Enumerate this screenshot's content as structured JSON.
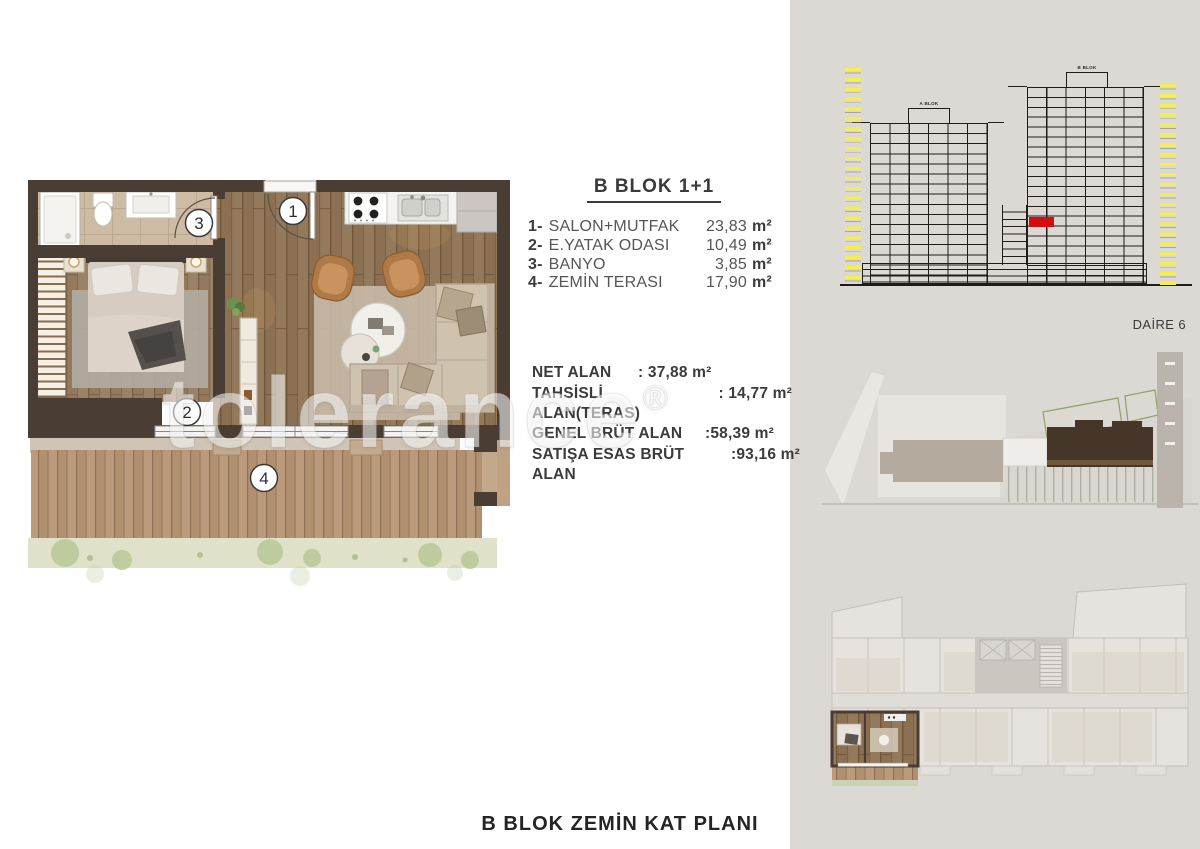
{
  "unit_info": {
    "title": "B BLOK 1+1",
    "rooms": [
      {
        "num": "1-",
        "label": "SALON+MUTFAK",
        "area": "23,83",
        "unit": "m²"
      },
      {
        "num": "2-",
        "label": "E.YATAK ODASI",
        "area": "10,49",
        "unit": "m²"
      },
      {
        "num": "3-",
        "label": "BANYO",
        "area": "3,85",
        "unit": "m²"
      },
      {
        "num": "4-",
        "label": "ZEMİN TERASI",
        "area": "17,90",
        "unit": "m²"
      }
    ],
    "areas_primary": [
      {
        "label": "NET ALAN",
        "value": ": 37,88 m²"
      },
      {
        "label": "TAHSİSLİ ALAN(TERAS)",
        "value": " : 14,77 m²"
      }
    ],
    "areas_secondary": [
      {
        "label": "GENEL BRÜT ALAN",
        "value": ":58,39 m²"
      },
      {
        "label": "SATIŞA ESAS BRÜT ALAN",
        "value": " :93,16 m²"
      }
    ]
  },
  "caption": "B BLOK ZEMİN KAT PLANI",
  "elevation": {
    "block_a_label": "A BLOK",
    "block_b_label": "B BLOK",
    "apartment_label": "DAİRE 6",
    "highlight_color": "#d60b0b",
    "marker_color": "#f2ef4e"
  },
  "floor_plan": {
    "room_numbers": [
      "1",
      "2",
      "3",
      "4"
    ]
  },
  "watermark": {
    "text": "tolerance",
    "symbol": "®"
  }
}
